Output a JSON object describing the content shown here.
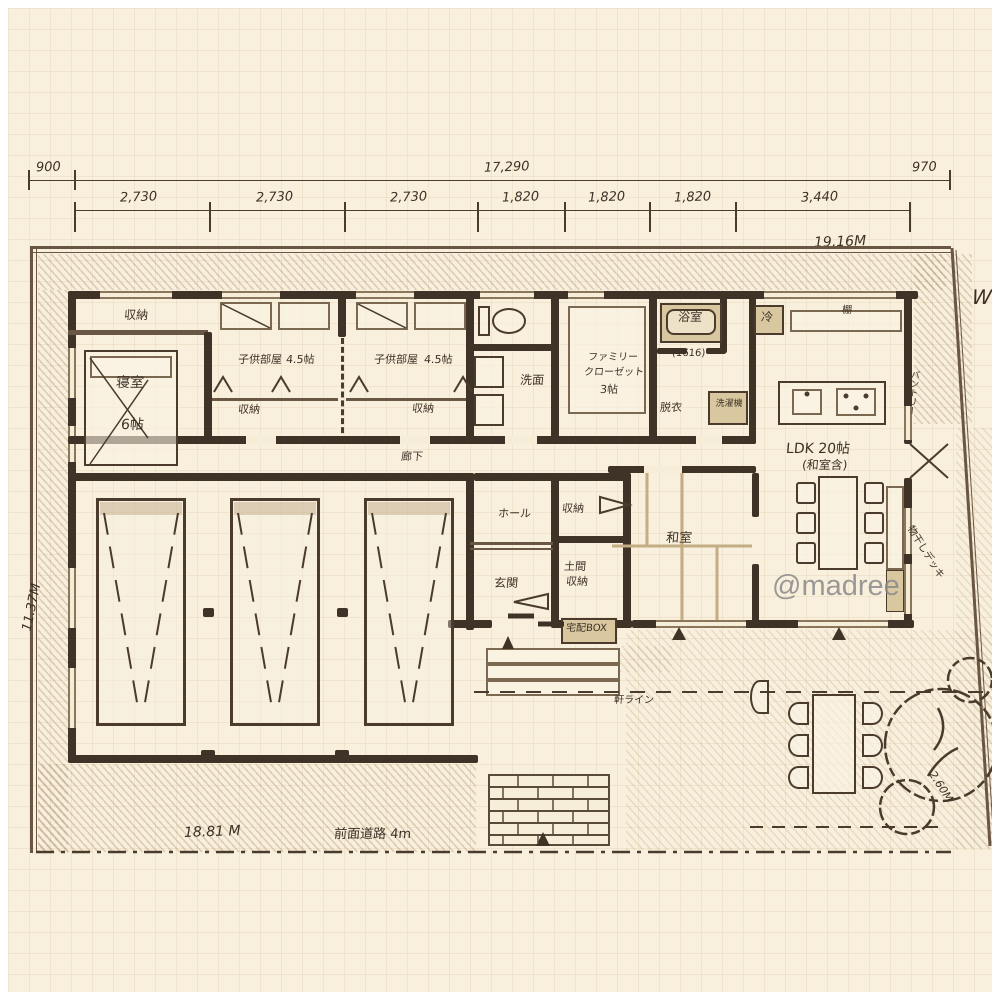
{
  "watermark": "@madree",
  "compass": "W",
  "dims": {
    "d900": "900",
    "d17290": "17,290",
    "d970": "970",
    "segs": [
      "2,730",
      "2,730",
      "2,730",
      "1,820",
      "1,820",
      "1,820",
      "3,440"
    ],
    "total_m": "19.16M",
    "side_m": "11.37M",
    "front_m": "18.81 M",
    "road": "前面道路 4m",
    "diag": "2.60M",
    "eave": "軒ライン"
  },
  "rooms": {
    "bedroom_closet": "収納",
    "bedroom": "寝室",
    "bedroom_size": "6帖",
    "kids1": "子供部屋",
    "kids1_size": "4.5帖",
    "kids1_closet": "収納",
    "kids2": "子供部屋",
    "kids2_size": "4.5帖",
    "kids2_closet": "収納",
    "washroom": "洗面",
    "family_closet_1": "ファミリー",
    "family_closet_2": "クローゼット",
    "family_closet_3": "3帖",
    "bath": "浴室",
    "bath_size": "(1616)",
    "dressing": "脱衣",
    "washer": "洗濯機",
    "fridge": "冷",
    "shelf": "棚",
    "pantry": "パントリー",
    "ldk": "LDK 20帖",
    "ldk_note": "(和室含)",
    "washitsu": "和室",
    "corridor": "廊下",
    "hall": "ホール",
    "hall_storage": "収納",
    "entrance": "玄関",
    "doma_1": "土間",
    "doma_2": "収納",
    "delivery_box": "宅配BOX",
    "deck": "物干しデッキ"
  }
}
